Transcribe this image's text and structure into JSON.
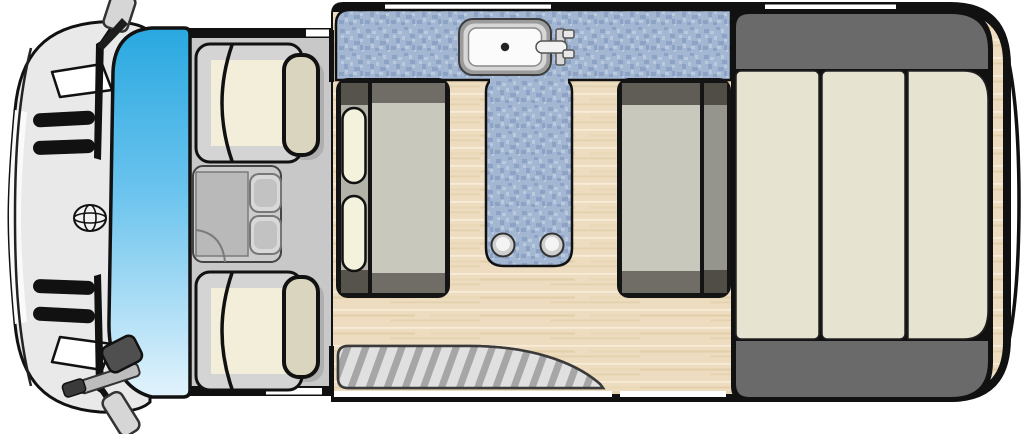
{
  "diagram": {
    "type": "campervan-floorplan-top-view",
    "items": [
      {
        "name": "van-front-hood"
      },
      {
        "name": "front-bumper"
      },
      {
        "name": "grille-slats",
        "count": 4
      },
      {
        "name": "brand-emblem"
      },
      {
        "name": "headlights",
        "count": 2
      },
      {
        "name": "wiper-blades",
        "count": 2
      },
      {
        "name": "side-mirrors",
        "count": 2
      },
      {
        "name": "windshield"
      },
      {
        "name": "cab-seats",
        "count": 2
      },
      {
        "name": "seat-headrests",
        "count": 2
      },
      {
        "name": "center-console-cupholders",
        "count": 2
      },
      {
        "name": "kitchen-counter"
      },
      {
        "name": "sink-with-faucet"
      },
      {
        "name": "dinette-table",
        "legs": 2
      },
      {
        "name": "bench-seat-front"
      },
      {
        "name": "bench-seat-rear"
      },
      {
        "name": "bench-pillows",
        "count": 2
      },
      {
        "name": "rear-bed-cushions",
        "count": 3
      },
      {
        "name": "entry-step"
      },
      {
        "name": "wood-floor"
      }
    ]
  },
  "colors": {
    "body_outline": "#111111",
    "white_seam": "#ffffff",
    "counter_blue_base": "#a3b7d3",
    "counter_blue_dark": "#8ca3c5",
    "counter_blue_light": "#b9c9de",
    "windshield_top": "#29a8e0",
    "windshield_mid": "#6cc4ee",
    "windshield_bottom": "#e2f3fc",
    "wood_base": "#eddcbf",
    "wood_light": "#f6ecd8",
    "wood_dark": "#e0c9a2",
    "cab_floor": "#c8c8c8",
    "hood_fill": "#e9e9e9",
    "bumper_white": "#fafafa",
    "seat_gray": "#d4d4d4",
    "seat_cream": "#f2eeda",
    "headrest_cream": "#d9d5bf",
    "console_gray": "#cccccc",
    "console_panel": "#b9b9b9",
    "cupholder": "#d8d8d8",
    "bench_seat": "#c9c8bc",
    "bench_band_dark": "#5f5d55",
    "bench_strip": "#b4b3aa",
    "bench_strip_rear": "#96958d",
    "pillow_cream": "#f4f1dd",
    "bed_bolster": "#6a6a6a",
    "bed_cushion": "#e6e3d1",
    "step_bg": "#e0e0e0",
    "step_stripe": "#a6a6a6",
    "sink_rim": "#9b9b9b",
    "sink_mid": "#d7d7d7",
    "sink_basin": "#fbfbfb",
    "mirror_dark": "#4f4f4f",
    "mirror_light": "#d6d6d6"
  }
}
